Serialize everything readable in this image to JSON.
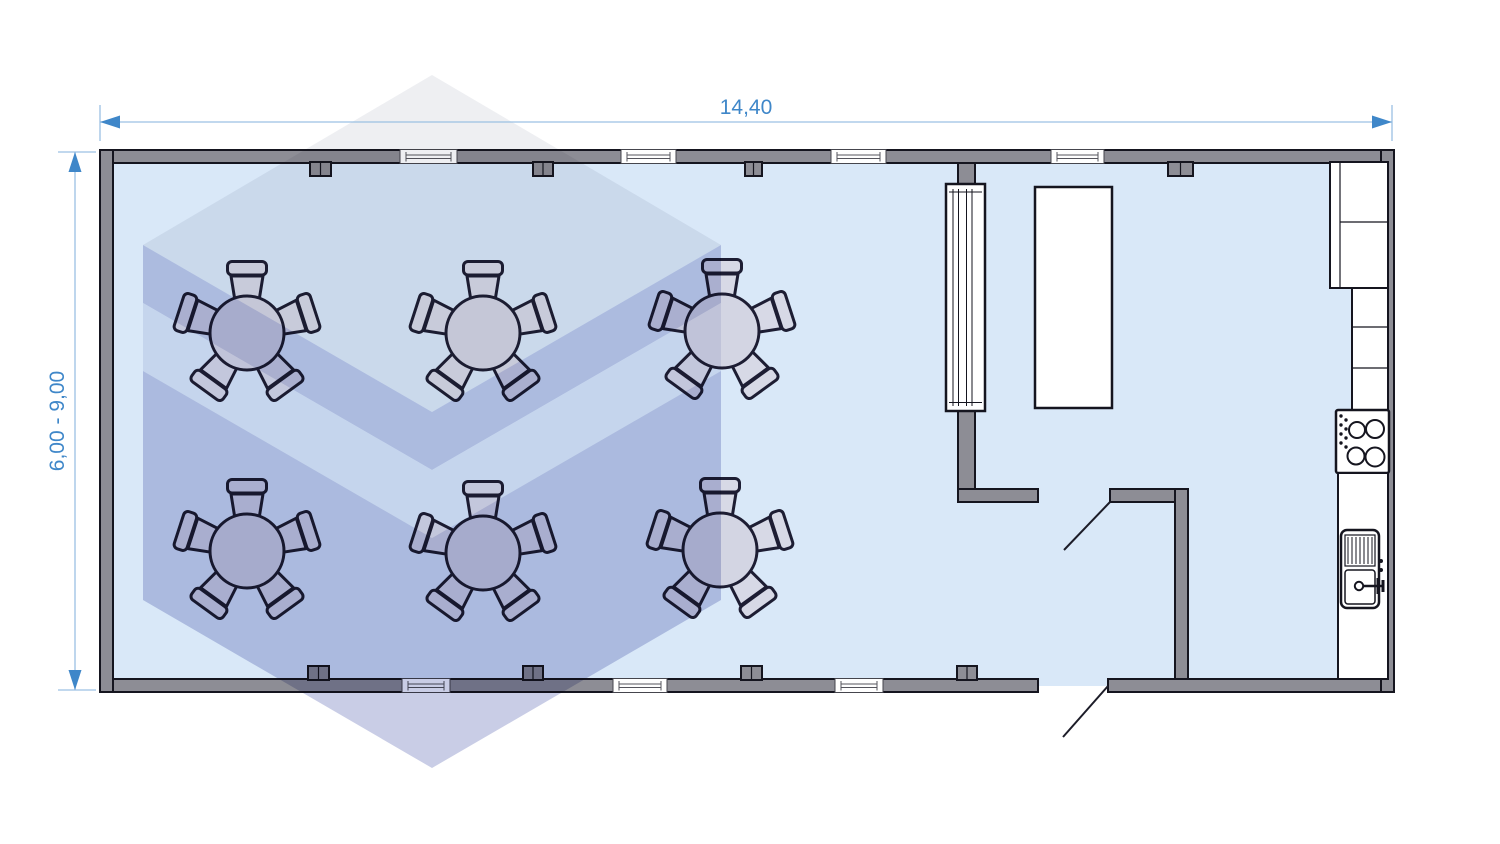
{
  "page": {
    "background": "#ffffff",
    "type": "modular-building-floor-plan"
  },
  "dimensions": {
    "width_label": "14,40",
    "height_label": "6,00 - 9,00",
    "text_color": "#3f87c9",
    "line_color": "#9cc0e3"
  },
  "palette": {
    "floor": "#d9e8f8",
    "wall": "#8d8d95",
    "outline": "#15151f",
    "furniture_fill": "#d7d9e6",
    "fixture_fill": "#ffffff",
    "watermark_light": "#e9eaef",
    "watermark_purple": "#c0c4e2"
  },
  "layout": {
    "windows_top": 4,
    "windows_bottom": 3,
    "entrance_doors": 1,
    "interior_doors": 1,
    "glazed_partition": true,
    "rooms": [
      "dining-hall",
      "serving-corridor",
      "kitchen"
    ]
  },
  "furniture": {
    "chairs_per_table": 5,
    "tables": [
      {
        "x": 247,
        "y": 333
      },
      {
        "x": 483,
        "y": 333
      },
      {
        "x": 722,
        "y": 331
      },
      {
        "x": 247,
        "y": 551
      },
      {
        "x": 483,
        "y": 553
      },
      {
        "x": 720,
        "y": 550
      }
    ],
    "serving_table": {
      "x": 1035,
      "y": 187,
      "width": 77,
      "height": 221
    },
    "kitchen_items": [
      "wall-cabinet-block",
      "tall-cabinet-run",
      "stove-4-burner",
      "worktop-counter",
      "sink-with-drainboard"
    ]
  }
}
